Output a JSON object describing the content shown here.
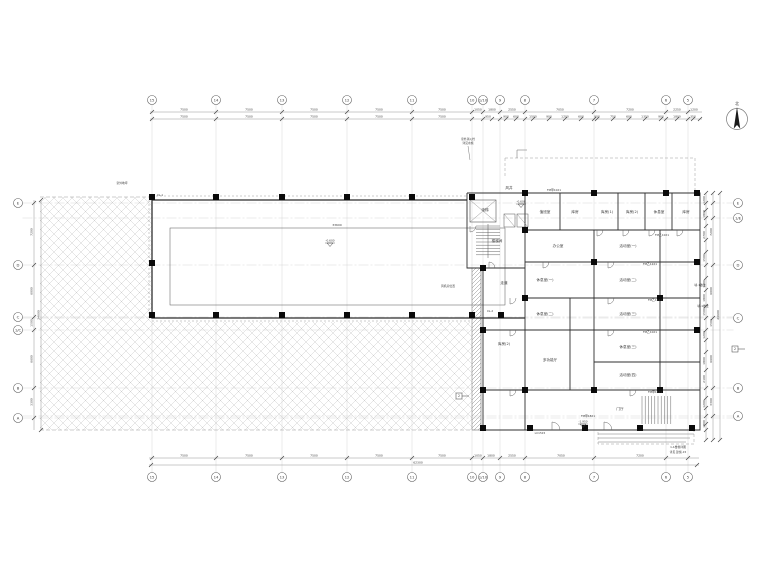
{
  "meta": {
    "drawing_type": "architectural floor plan",
    "north_label": "北"
  },
  "colors": {
    "bg": "#ffffff",
    "wall": "#2f2f2f",
    "thin": "#555555",
    "grid": "#c5c5c5",
    "hatch": "#cfcfcf",
    "dim": "#8a8a8a",
    "tick": "#444444",
    "text": "#3c3c3c",
    "column": "#0a0a0a",
    "dashed": "#999999"
  },
  "grid": {
    "cols": [
      {
        "x": 152,
        "label": "15"
      },
      {
        "x": 216,
        "label": "14"
      },
      {
        "x": 282,
        "label": "13"
      },
      {
        "x": 347,
        "label": "12"
      },
      {
        "x": 412,
        "label": "11"
      },
      {
        "x": 472,
        "label": "10"
      },
      {
        "x": 483,
        "label": "1/10"
      },
      {
        "x": 500,
        "label": "9"
      },
      {
        "x": 525,
        "label": "8"
      },
      {
        "x": 594,
        "label": "7"
      },
      {
        "x": 666,
        "label": "6"
      },
      {
        "x": 688,
        "label": "5"
      }
    ],
    "rows_left": [
      {
        "y": 203,
        "label": "E"
      },
      {
        "y": 265,
        "label": "D"
      },
      {
        "y": 317,
        "label": "C"
      },
      {
        "y": 330,
        "label": "1/C"
      },
      {
        "y": 388,
        "label": "B"
      },
      {
        "y": 418,
        "label": "A"
      }
    ],
    "rows_right": [
      {
        "y": 203,
        "label": "E"
      },
      {
        "y": 218,
        "label": "1/E"
      },
      {
        "y": 265,
        "label": "D"
      },
      {
        "y": 318,
        "label": "C"
      },
      {
        "y": 388,
        "label": "B"
      },
      {
        "y": 416,
        "label": "A"
      }
    ]
  },
  "dimensions": {
    "top_row1": [
      {
        "x": 184,
        "v": "7500"
      },
      {
        "x": 249,
        "v": "7500"
      },
      {
        "x": 314,
        "v": "7500"
      },
      {
        "x": 379,
        "v": "7500"
      },
      {
        "x": 442,
        "v": "7500"
      },
      {
        "x": 478,
        "v": "1050"
      },
      {
        "x": 492,
        "v": "1800"
      },
      {
        "x": 512,
        "v": "2550"
      },
      {
        "x": 560,
        "v": "7050"
      },
      {
        "x": 630,
        "v": "7200"
      },
      {
        "x": 677,
        "v": "2250"
      },
      {
        "x": 694,
        "v": "1200"
      }
    ],
    "top_row2": [
      {
        "x": 184,
        "v": "7500"
      },
      {
        "x": 249,
        "v": "7500"
      },
      {
        "x": 314,
        "v": "7500"
      },
      {
        "x": 379,
        "v": "7500"
      },
      {
        "x": 442,
        "v": "7500"
      },
      {
        "x": 488,
        "v": "950"
      },
      {
        "x": 506,
        "v": "900"
      },
      {
        "x": 516,
        "v": "600"
      },
      {
        "x": 533,
        "v": "1500"
      },
      {
        "x": 549,
        "v": "900"
      },
      {
        "x": 565,
        "v": "1200"
      },
      {
        "x": 581,
        "v": "600"
      },
      {
        "x": 597,
        "v": "900"
      },
      {
        "x": 613,
        "v": "750"
      },
      {
        "x": 629,
        "v": "600"
      },
      {
        "x": 645,
        "v": "1350"
      },
      {
        "x": 661,
        "v": "900"
      },
      {
        "x": 677,
        "v": "1800"
      },
      {
        "x": 693,
        "v": "350"
      }
    ],
    "bottom_row": [
      {
        "x": 184,
        "v": "7500"
      },
      {
        "x": 249,
        "v": "7500"
      },
      {
        "x": 314,
        "v": "7500"
      },
      {
        "x": 379,
        "v": "7500"
      },
      {
        "x": 442,
        "v": "7500"
      },
      {
        "x": 478,
        "v": "1050"
      },
      {
        "x": 491,
        "v": "1800"
      },
      {
        "x": 512,
        "v": "2550"
      },
      {
        "x": 561,
        "v": "7050"
      },
      {
        "x": 640,
        "v": "7200"
      }
    ],
    "bottom_total": {
      "x": 418,
      "v": "62300"
    },
    "left_chain": [
      {
        "y": 232,
        "v": "7200"
      },
      {
        "y": 291,
        "v": "6000"
      },
      {
        "y": 323,
        "v": "1500"
      },
      {
        "y": 359,
        "v": "6600"
      },
      {
        "y": 402,
        "v": "3300"
      }
    ],
    "left_total": {
      "y": 315,
      "v": "24600"
    },
    "right_chain1": [
      {
        "y": 200,
        "v": "1200"
      },
      {
        "y": 214,
        "v": "1800"
      },
      {
        "y": 235,
        "v": "2700"
      },
      {
        "y": 258,
        "v": "1500"
      },
      {
        "y": 284,
        "v": "1200"
      },
      {
        "y": 298,
        "v": "1800"
      },
      {
        "y": 312,
        "v": "1500"
      },
      {
        "y": 335,
        "v": "1200"
      },
      {
        "y": 361,
        "v": "1800"
      },
      {
        "y": 379,
        "v": "2100"
      },
      {
        "y": 404,
        "v": "1200"
      },
      {
        "y": 424,
        "v": "1800"
      }
    ],
    "right_chain2": [
      {
        "y": 232,
        "v": "7200"
      },
      {
        "y": 291,
        "v": "6000"
      },
      {
        "y": 323,
        "v": "1500"
      },
      {
        "y": 359,
        "v": "6600"
      },
      {
        "y": 402,
        "v": "3300"
      }
    ],
    "right_total": {
      "y": 315,
      "v": "24600"
    },
    "inner": [
      {
        "x": 337,
        "y": 226,
        "v": "33600"
      }
    ]
  },
  "rooms": [
    {
      "x": 485,
      "y": 211,
      "label": "电梯"
    },
    {
      "x": 497,
      "y": 242,
      "label": "楼梯间"
    },
    {
      "x": 509,
      "y": 189,
      "label": "风井"
    },
    {
      "x": 545,
      "y": 213,
      "label": "值班室"
    },
    {
      "x": 575,
      "y": 213,
      "label": "库房"
    },
    {
      "x": 607,
      "y": 213,
      "label": "库房(1)"
    },
    {
      "x": 632,
      "y": 213,
      "label": "库房(2)"
    },
    {
      "x": 659,
      "y": 213,
      "label": "休息室"
    },
    {
      "x": 686,
      "y": 213,
      "label": "库房"
    },
    {
      "x": 558,
      "y": 247,
      "label": "办公室"
    },
    {
      "x": 628,
      "y": 247,
      "label": "活动室(一)"
    },
    {
      "x": 545,
      "y": 281,
      "label": "休息室(一)"
    },
    {
      "x": 628,
      "y": 281,
      "label": "活动室(二)"
    },
    {
      "x": 504,
      "y": 284,
      "label": "走道"
    },
    {
      "x": 545,
      "y": 315,
      "label": "休息室(二)"
    },
    {
      "x": 628,
      "y": 315,
      "label": "活动室(三)"
    },
    {
      "x": 504,
      "y": 345,
      "label": "库房(2)"
    },
    {
      "x": 550,
      "y": 361,
      "label": "多功能厅"
    },
    {
      "x": 628,
      "y": 348,
      "label": "休息室(三)"
    },
    {
      "x": 628,
      "y": 376,
      "label": "活动室(四)"
    },
    {
      "x": 620,
      "y": 410,
      "label": "门厅"
    }
  ],
  "notes": [
    {
      "x": 468,
      "y": 140,
      "text": "室外消火栓"
    },
    {
      "x": 468,
      "y": 144,
      "text": "详见水施"
    },
    {
      "x": 448,
      "y": 287,
      "text": "风机房位置"
    },
    {
      "x": 122,
      "y": 184,
      "text": "室外地坪"
    },
    {
      "x": 160,
      "y": 196,
      "text": "XL-1"
    },
    {
      "x": 490,
      "y": 312,
      "text": "XL-2"
    },
    {
      "x": 554,
      "y": 191,
      "text": "FM甲1021"
    },
    {
      "x": 662,
      "y": 236,
      "text": "FM乙1021"
    },
    {
      "x": 650,
      "y": 265,
      "text": "FM乙1221"
    },
    {
      "x": 655,
      "y": 301,
      "text": "FM乙1221"
    },
    {
      "x": 650,
      "y": 333,
      "text": "FM乙1021"
    },
    {
      "x": 655,
      "y": 393,
      "text": "FM甲1521"
    },
    {
      "x": 588,
      "y": 417,
      "text": "FM甲1821"
    },
    {
      "x": 700,
      "y": 286,
      "text": "墙-1做法"
    },
    {
      "x": 703,
      "y": 307,
      "text": "墙-1做法"
    },
    {
      "x": 540,
      "y": 434,
      "text": "LC1515"
    },
    {
      "x": 678,
      "y": 448,
      "text": "1-1楼梯详图"
    },
    {
      "x": 678,
      "y": 453,
      "text": "详见 建施-15"
    }
  ],
  "elevations": [
    {
      "x": 330,
      "y": 243,
      "value": "-0.600"
    },
    {
      "x": 521,
      "y": 204,
      "value": "-0.600"
    },
    {
      "x": 583,
      "y": 424,
      "value": "-1.950"
    }
  ],
  "section_markers": [
    {
      "x": 459,
      "y": 396,
      "label": "2"
    },
    {
      "x": 735,
      "y": 349,
      "label": "2"
    }
  ]
}
